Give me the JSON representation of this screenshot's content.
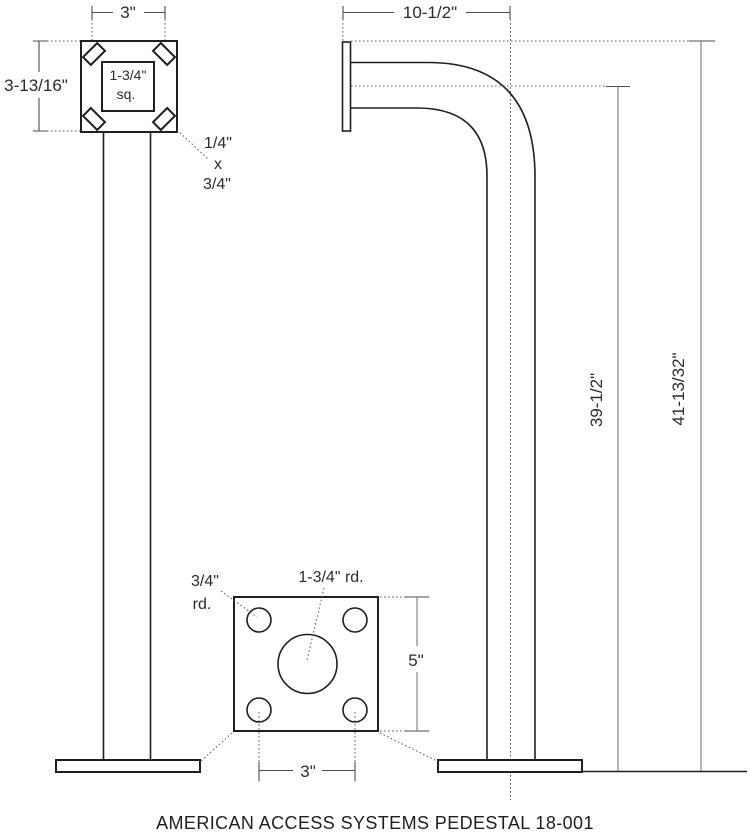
{
  "caption": "AMERICAN ACCESS SYSTEMS PEDESTAL 18-001",
  "front_view": {
    "width_dim": "3\"",
    "height_dim": "3-13/16\"",
    "center_tube_label_line1": "1-3/4\"",
    "center_tube_label_line2": "sq.",
    "tab_size_line1": "1/4\"",
    "tab_size_line2": "x",
    "tab_size_line3": "3/4\""
  },
  "side_view": {
    "reach_dim": "10-1/2\"",
    "center_height_dim": "39-1/2\"",
    "overall_height_dim": "41-13/32\""
  },
  "base_plate_detail": {
    "corner_hole_dim_line1": "3/4\"",
    "corner_hole_dim_line2": "rd.",
    "center_hole_dim": "1-3/4\" rd.",
    "plate_size_dim": "5\"",
    "hole_spacing_dim": "3\""
  },
  "colors": {
    "drawing_line": "#1f1f1f",
    "dimension_line": "#4d4d4d",
    "background": "#ffffff"
  }
}
